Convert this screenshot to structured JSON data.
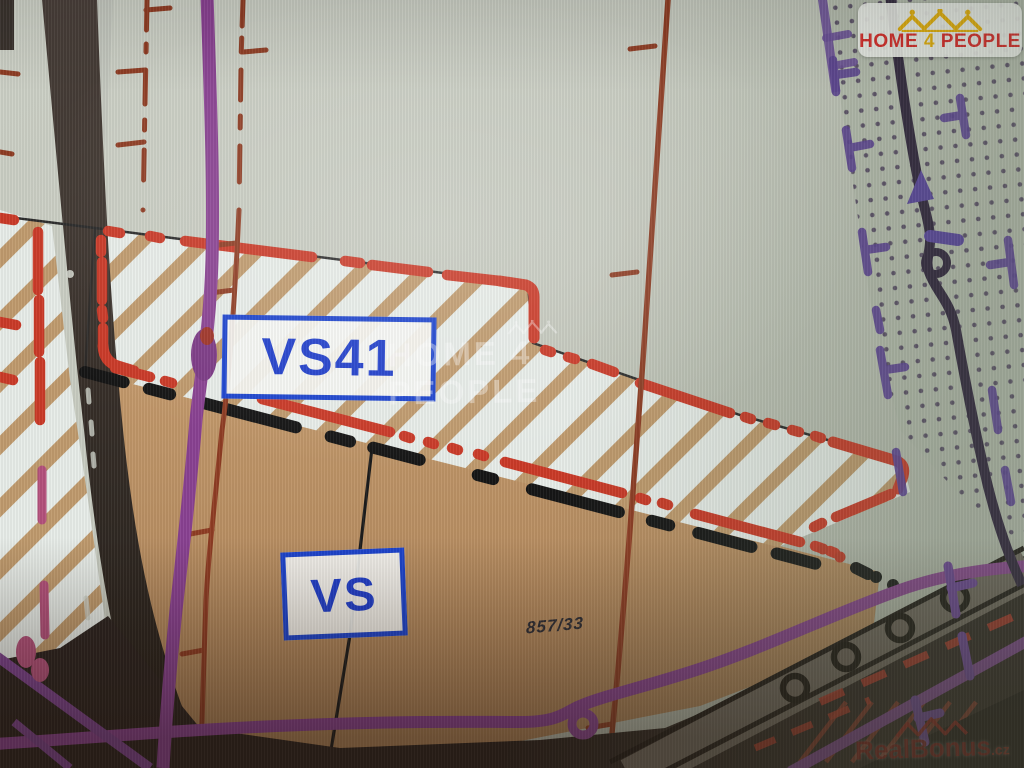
{
  "map": {
    "type": "zoning-plan-photo",
    "zones": [
      {
        "code": "VS41",
        "style": "hatched-red-dashed-boundary"
      },
      {
        "code": "VS",
        "style": "solid-tan"
      }
    ],
    "labels": {
      "vs41": "VS41",
      "vs": "VS"
    },
    "parcel_number": "857/33",
    "colors": {
      "label_blue": "#1d45cf",
      "boundary_red": "#cb3a28",
      "utility_purple": "#8a4292",
      "zone_tan": "#c0915f",
      "hatch_background": "#e8ede9",
      "road_dark": "#3c332d",
      "background": "#c2c6bb"
    }
  },
  "branding": {
    "logo": {
      "home": "HOME",
      "four": "4",
      "people": "PEOPLE",
      "red": "#e02020",
      "gold": "#f0b400"
    },
    "watermark_center": {
      "text": "HOME 4 PEOPLE"
    },
    "watermark_bottom": {
      "name": "RealBonus",
      "tld": ".cz"
    }
  }
}
